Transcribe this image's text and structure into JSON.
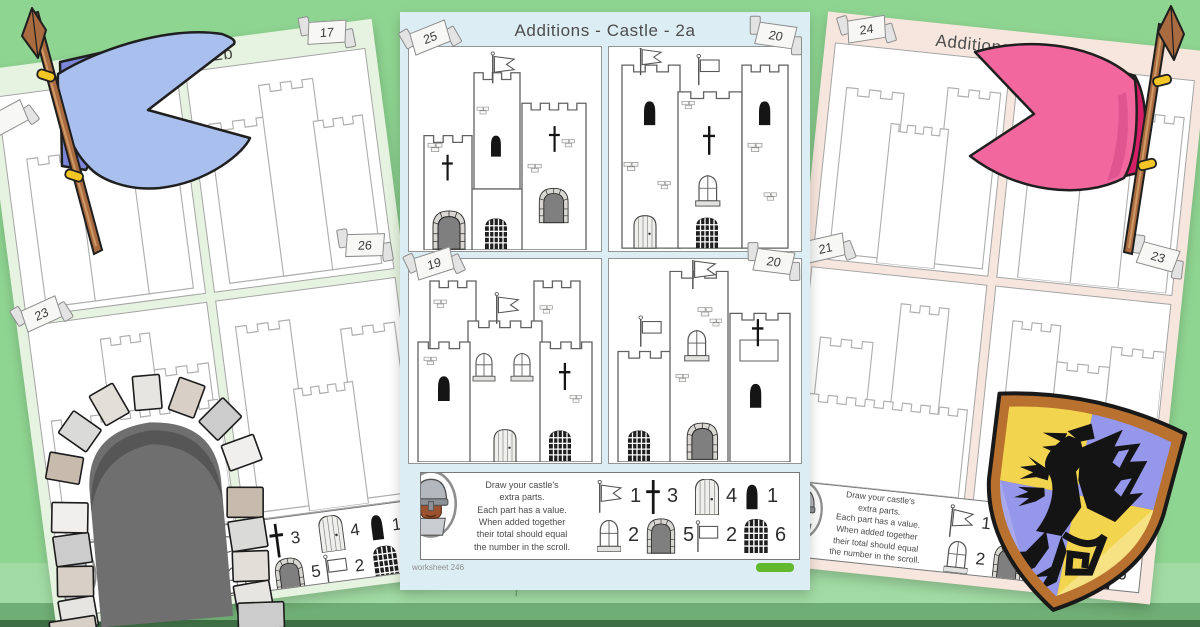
{
  "colors": {
    "background": "#8fd592",
    "grassMid": "#6fae74",
    "grassDark": "#3e6e44",
    "pageCenter": "#dcedf4",
    "pageLeft": "#e6f3e0",
    "pageRight": "#f7e6dd",
    "flagBlue": "#a9bfee",
    "flagBlueDark": "#7b86d9",
    "flagPink": "#f3679f",
    "flagPinkDark": "#d41f66",
    "pole": "#a96b3f",
    "gold": "#f4c625",
    "shieldYellow": "#f3d44e",
    "shieldPurple": "#9597ea",
    "shieldBorder": "#b9712f",
    "logoGreen": "#62b92e"
  },
  "pages": {
    "center": {
      "title": "Additions - Castle - 2a",
      "footer": "worksheet 246",
      "scrolls": {
        "q1": "25",
        "q2": "20",
        "q3": "19",
        "q4": "20"
      }
    },
    "left": {
      "title": "- Castle - 2b",
      "scrolls": {
        "q2": "17",
        "q3": "23",
        "q4": "26"
      }
    },
    "right": {
      "title": "Additions -",
      "scrolls": {
        "q1": "24",
        "q3": "21",
        "q4": "23"
      }
    }
  },
  "instructions": {
    "line1": "Draw your castle's",
    "line2": "extra parts.",
    "line3": "Each part has a value.",
    "line4": "When added together",
    "line5": "their total should equal",
    "line6": "the number in the scroll."
  },
  "legend": {
    "items": [
      {
        "icon": "pennant-flag-icon",
        "value": "1"
      },
      {
        "icon": "cross-icon",
        "value": "3"
      },
      {
        "icon": "wooden-door-icon",
        "value": "4"
      },
      {
        "icon": "arrow-slit-icon",
        "value": "1"
      },
      {
        "icon": "arched-window-icon",
        "value": "2"
      },
      {
        "icon": "stone-arch-door-icon",
        "value": "5"
      },
      {
        "icon": "rectangle-flag-icon",
        "value": "2"
      },
      {
        "icon": "portcullis-icon",
        "value": "6"
      }
    ]
  }
}
